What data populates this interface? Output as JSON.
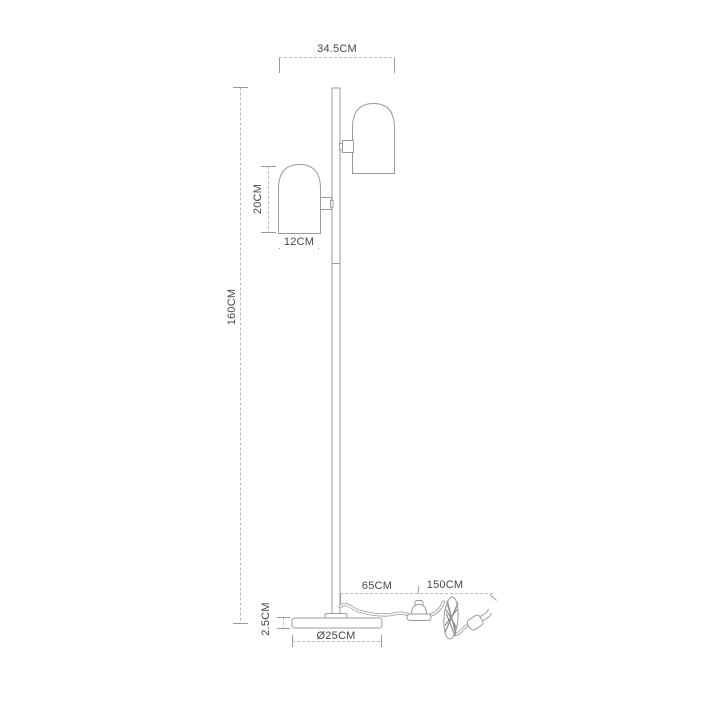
{
  "page": {
    "background": "#ffffff"
  },
  "drawing": {
    "subject": "dimension-drawing-of-two-light-floor-lamp",
    "parts": [
      "pole",
      "upper-dome-shade",
      "lower-dome-shade",
      "round-base",
      "power-cord",
      "foot-switch",
      "coiled-cord",
      "power-plug"
    ],
    "colors": {
      "outline": "#9b9b9b",
      "dimension_line": "#bcbcbc",
      "label_text": "#474747",
      "background": "#ffffff"
    }
  },
  "dimensions": {
    "top_width": {
      "label": "34.5CM"
    },
    "total_height": {
      "label": "160CM"
    },
    "shade_height": {
      "label": "20CM"
    },
    "shade_width": {
      "label": "12CM"
    },
    "base_height": {
      "label": "2.5CM"
    },
    "base_diameter": {
      "label": "Ø25CM"
    },
    "cord_pole_to_switch": {
      "label": "65CM"
    },
    "cord_switch_to_plug": {
      "label": "150CM"
    }
  }
}
